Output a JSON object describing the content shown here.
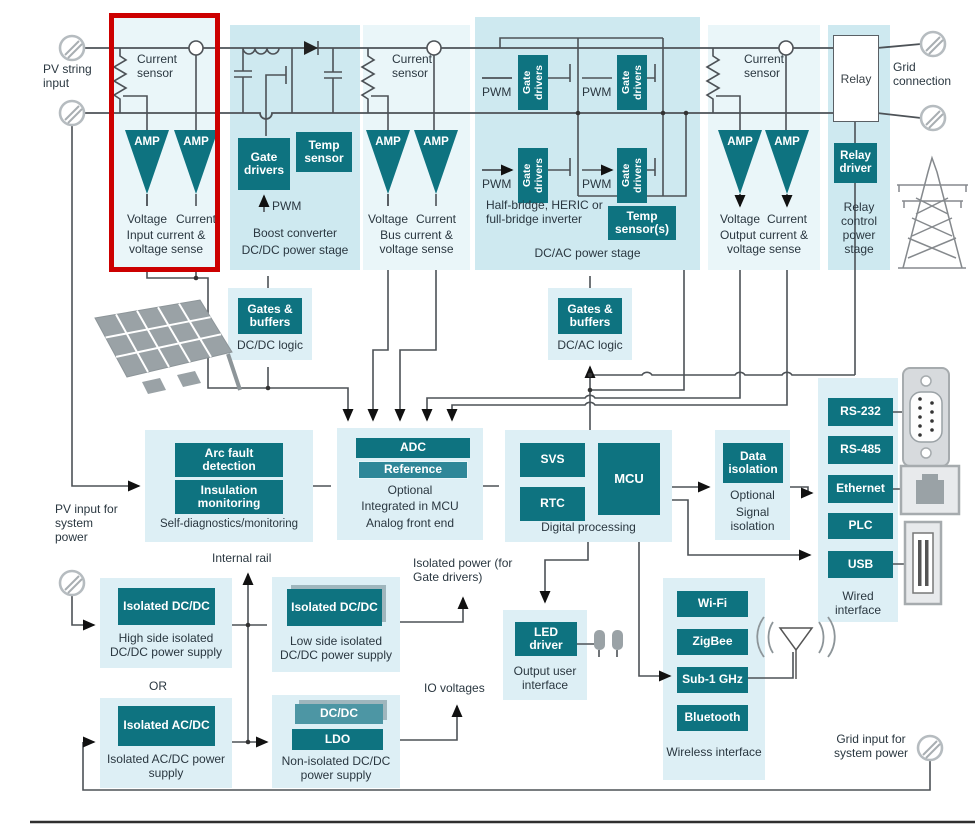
{
  "colors": {
    "teal": "#0e7380",
    "teal_light": "#4d96a4",
    "panel_power": "#cee9f0",
    "panel": "#ddeff5",
    "panel_sense": "#eaf6f9",
    "highlight_red": "#cc0000"
  },
  "labels": {
    "amp": "AMP",
    "pwm": "PWM",
    "current_sensor": "Current sensor",
    "voltage": "Voltage",
    "current": "Current",
    "gates_buffers": "Gates & buffers",
    "gate_drivers": "Gate drivers",
    "isolated_dcdc": "Isolated DC/DC"
  },
  "top": {
    "pv_input": "PV string input",
    "sense_input": {
      "caption": "Input current & voltage sense"
    },
    "boost": {
      "temp": "Temp sensor",
      "line1": "Boost converter",
      "line2": "DC/DC power stage"
    },
    "sense_bus": {
      "caption": "Bus current & voltage sense"
    },
    "inverter": {
      "desc": "Half-bridge, HERIC or full-bridge inverter",
      "temp": "Temp sensor(s)",
      "caption": "DC/AC power stage"
    },
    "sense_output": {
      "caption": "Output current & voltage sense"
    },
    "relay": {
      "box": "Relay",
      "driver": "Relay driver",
      "caption": "Relay control power stage"
    },
    "grid": "Grid connection"
  },
  "logic": {
    "dcdc": "DC/DC logic",
    "dcac": "DC/AC logic"
  },
  "middle": {
    "selfdiag": {
      "arc": "Arc fault detection",
      "insulation": "Insulation monitoring",
      "caption": "Self-diagnostics/monitoring"
    },
    "afe": {
      "adc": "ADC",
      "reference": "Reference",
      "line1": "Optional",
      "line2": "Integrated in MCU",
      "line3": "Analog front end"
    },
    "digital": {
      "svs": "SVS",
      "rtc": "RTC",
      "mcu": "MCU",
      "caption": "Digital processing"
    },
    "isolation": {
      "chip": "Data isolation",
      "line1": "Optional",
      "line2": "Signal isolation"
    },
    "pv_system": "PV input for system power"
  },
  "wired": {
    "items": [
      "RS-232",
      "RS-485",
      "Ethernet",
      "PLC",
      "USB"
    ],
    "caption": "Wired interface"
  },
  "wireless": {
    "items": [
      "Wi-Fi",
      "ZigBee",
      "Sub-1 GHz",
      "Bluetooth"
    ],
    "caption": "Wireless interface"
  },
  "power": {
    "internal_rail": "Internal rail",
    "isolated_power": "Isolated power (for Gate drivers)",
    "io_voltages": "IO voltages",
    "or_label": "OR",
    "high_side": {
      "caption": "High side isolated DC/DC power supply"
    },
    "low_side": {
      "caption": "Low side isolated DC/DC power supply"
    },
    "acdc": {
      "chip": "Isolated AC/DC",
      "caption": "Isolated AC/DC power supply"
    },
    "non_isolated": {
      "dcdc": "DC/DC",
      "ldo": "LDO",
      "caption": "Non-isolated DC/DC power supply"
    },
    "grid_input": "Grid input for system power"
  },
  "ui": {
    "led": {
      "chip": "LED driver",
      "caption": "Output user interface"
    }
  }
}
